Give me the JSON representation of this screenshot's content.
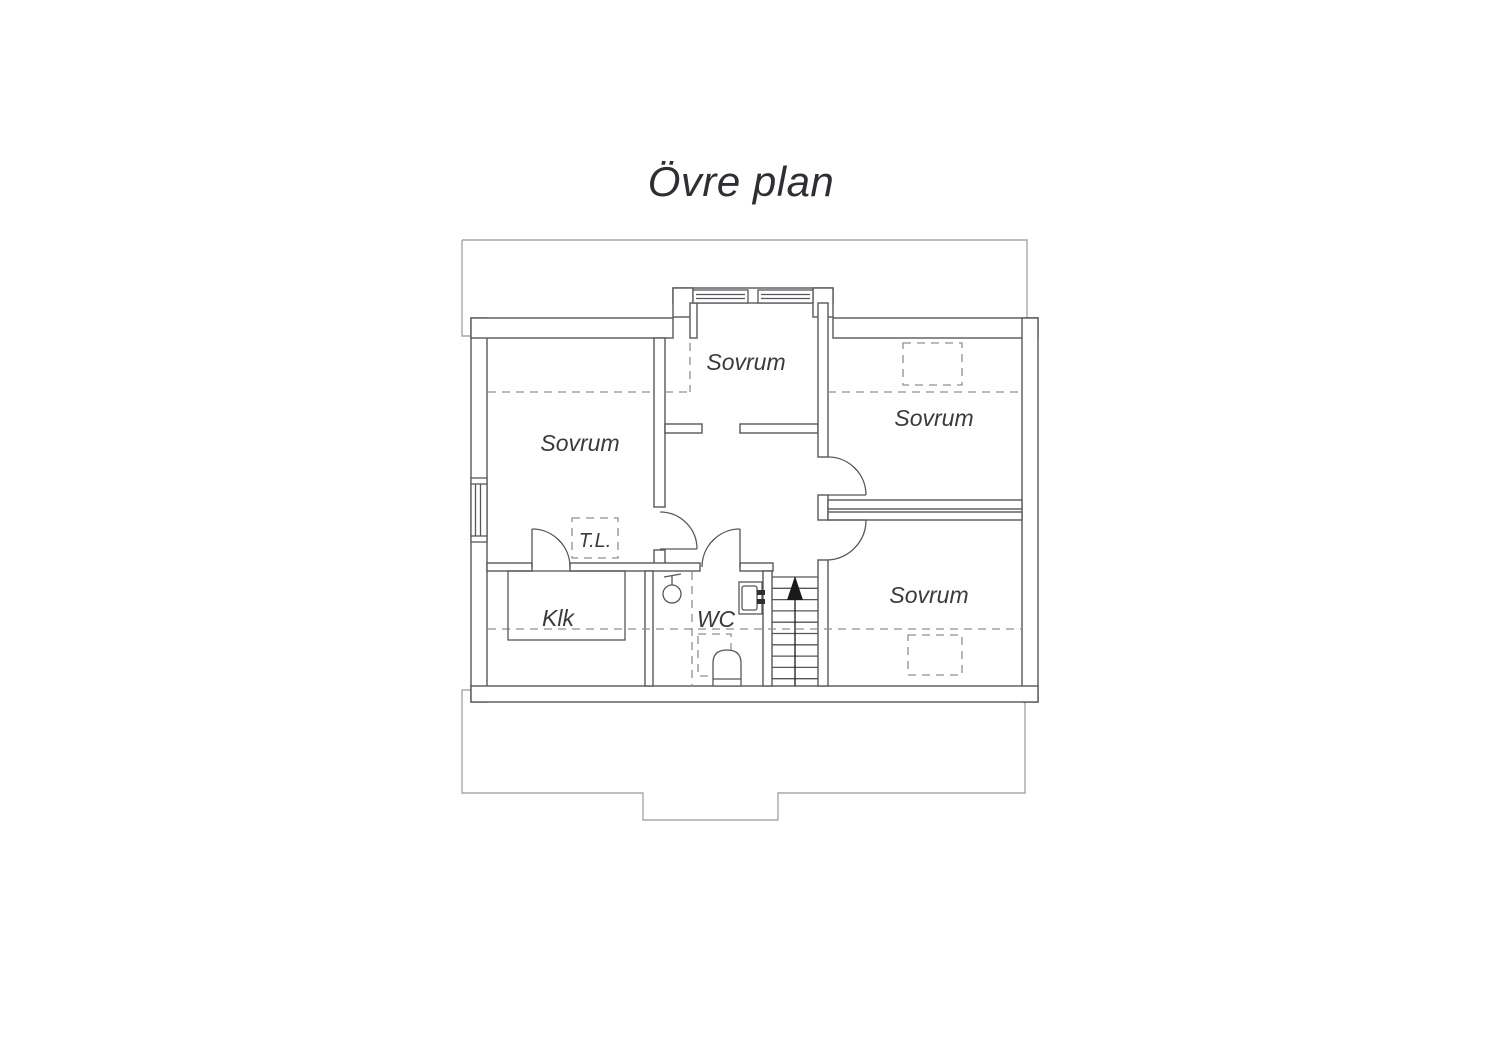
{
  "title": "Övre plan",
  "floorplan": {
    "rooms": {
      "sovrum_left": {
        "label": "Sovrum"
      },
      "sovrum_top": {
        "label": "Sovrum"
      },
      "sovrum_right_top": {
        "label": "Sovrum"
      },
      "sovrum_right_bottom": {
        "label": "Sovrum"
      },
      "klk": {
        "label": "Klk"
      },
      "wc": {
        "label": "WC"
      },
      "tl": {
        "label": "T.L."
      }
    },
    "icons": {
      "stairs": "up-arrow-icon",
      "shower": "shower-icon",
      "sink": "sink-icon",
      "toilet": "toilet-icon",
      "windows": "window-icon"
    },
    "colors": {
      "wall": "#56575b",
      "eaves": "#a9a9ad",
      "dashed": "#8f9094",
      "text": "#3a3b40",
      "arrow": "#1a1a1a",
      "background": "#ffffff"
    }
  }
}
